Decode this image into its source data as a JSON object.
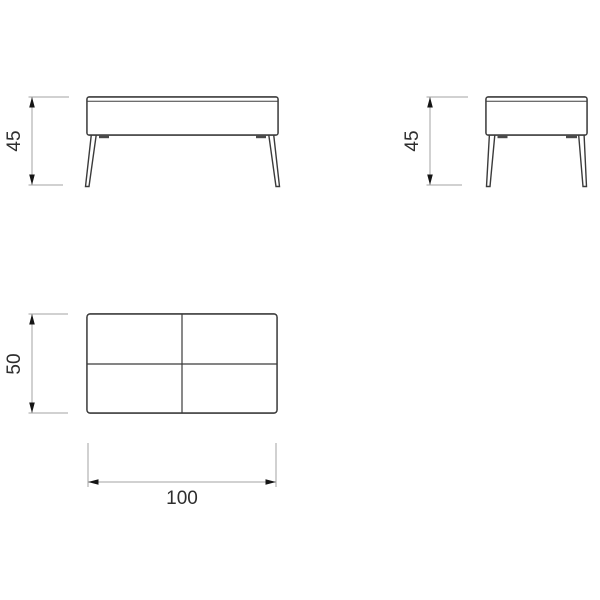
{
  "drawing": {
    "front_view": {
      "height_label": "45"
    },
    "side_view": {
      "height_label": "45"
    },
    "top_view": {
      "depth_label": "50",
      "width_label": "100"
    }
  },
  "colors": {
    "background": "#ffffff",
    "outline": "#3b3b3b",
    "hatch_line": "#3f3f3f",
    "dimension_line": "#a3a3a3",
    "arrow": "#151515",
    "label_text": "#2e2e2e"
  }
}
